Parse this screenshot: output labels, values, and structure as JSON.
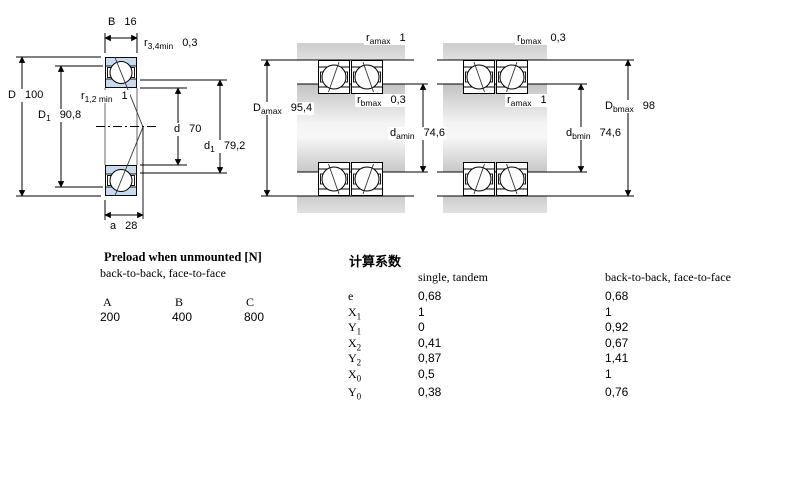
{
  "colors": {
    "bearing_ring_fill": "#c9daee",
    "housing_gray": "#d2d2d2",
    "shaft_gray_light": "#f4f4f4",
    "line": "#000000"
  },
  "left_drawing": {
    "dims": {
      "B": {
        "sym": "B",
        "sub": "",
        "val": "16"
      },
      "r34": {
        "sym": "r",
        "sub": "3,4min",
        "val": "0,3"
      },
      "D": {
        "sym": "D",
        "sub": "",
        "val": "100"
      },
      "r12": {
        "sym": "r",
        "sub": "1,2 min",
        "val": "1"
      },
      "D1": {
        "sym": "D",
        "sub": "1",
        "val": "90,8"
      },
      "d": {
        "sym": "d",
        "sub": "",
        "val": "70"
      },
      "d1": {
        "sym": "d",
        "sub": "1",
        "val": "79,2"
      },
      "a": {
        "sym": "a",
        "sub": "",
        "val": "28"
      }
    }
  },
  "middle_drawing": {
    "dims": {
      "ramax": {
        "sym": "r",
        "sub": "amax",
        "val": "1"
      },
      "rbmax": {
        "sym": "r",
        "sub": "bmax",
        "val": "0,3"
      },
      "Damax": {
        "sym": "D",
        "sub": "amax",
        "val": "95,4"
      },
      "damin": {
        "sym": "d",
        "sub": "amin",
        "val": "74,6"
      }
    }
  },
  "right_drawing": {
    "dims": {
      "rbmax": {
        "sym": "r",
        "sub": "bmax",
        "val": "0,3"
      },
      "ramax": {
        "sym": "r",
        "sub": "amax",
        "val": "1"
      },
      "Dbmax": {
        "sym": "D",
        "sub": "bmax",
        "val": "98"
      },
      "dbmin": {
        "sym": "d",
        "sub": "bmin",
        "val": "74,6"
      }
    }
  },
  "preload": {
    "title": "Preload when unmounted [N]",
    "subtitle": "back-to-back, face-to-face",
    "columns": [
      "A",
      "B",
      "C"
    ],
    "values": [
      "200",
      "400",
      "800"
    ]
  },
  "factors": {
    "title": "计算系数",
    "col1_header": "single, tandem",
    "col2_header": "back-to-back, face-to-face",
    "rows": [
      {
        "base": "e",
        "sub": "",
        "v1": "0,68",
        "v2": "0,68"
      },
      {
        "base": "X",
        "sub": "1",
        "v1": "1",
        "v2": "1"
      },
      {
        "base": "Y",
        "sub": "1",
        "v1": "0",
        "v2": "0,92"
      },
      {
        "base": "X",
        "sub": "2",
        "v1": "0,41",
        "v2": "0,67"
      },
      {
        "base": "Y",
        "sub": "2",
        "v1": "0,87",
        "v2": "1,41"
      },
      {
        "base": "X",
        "sub": "0",
        "v1": "0,5",
        "v2": "1"
      },
      {
        "base": "Y",
        "sub": "0",
        "v1": "0,38",
        "v2": "0,76"
      }
    ]
  }
}
